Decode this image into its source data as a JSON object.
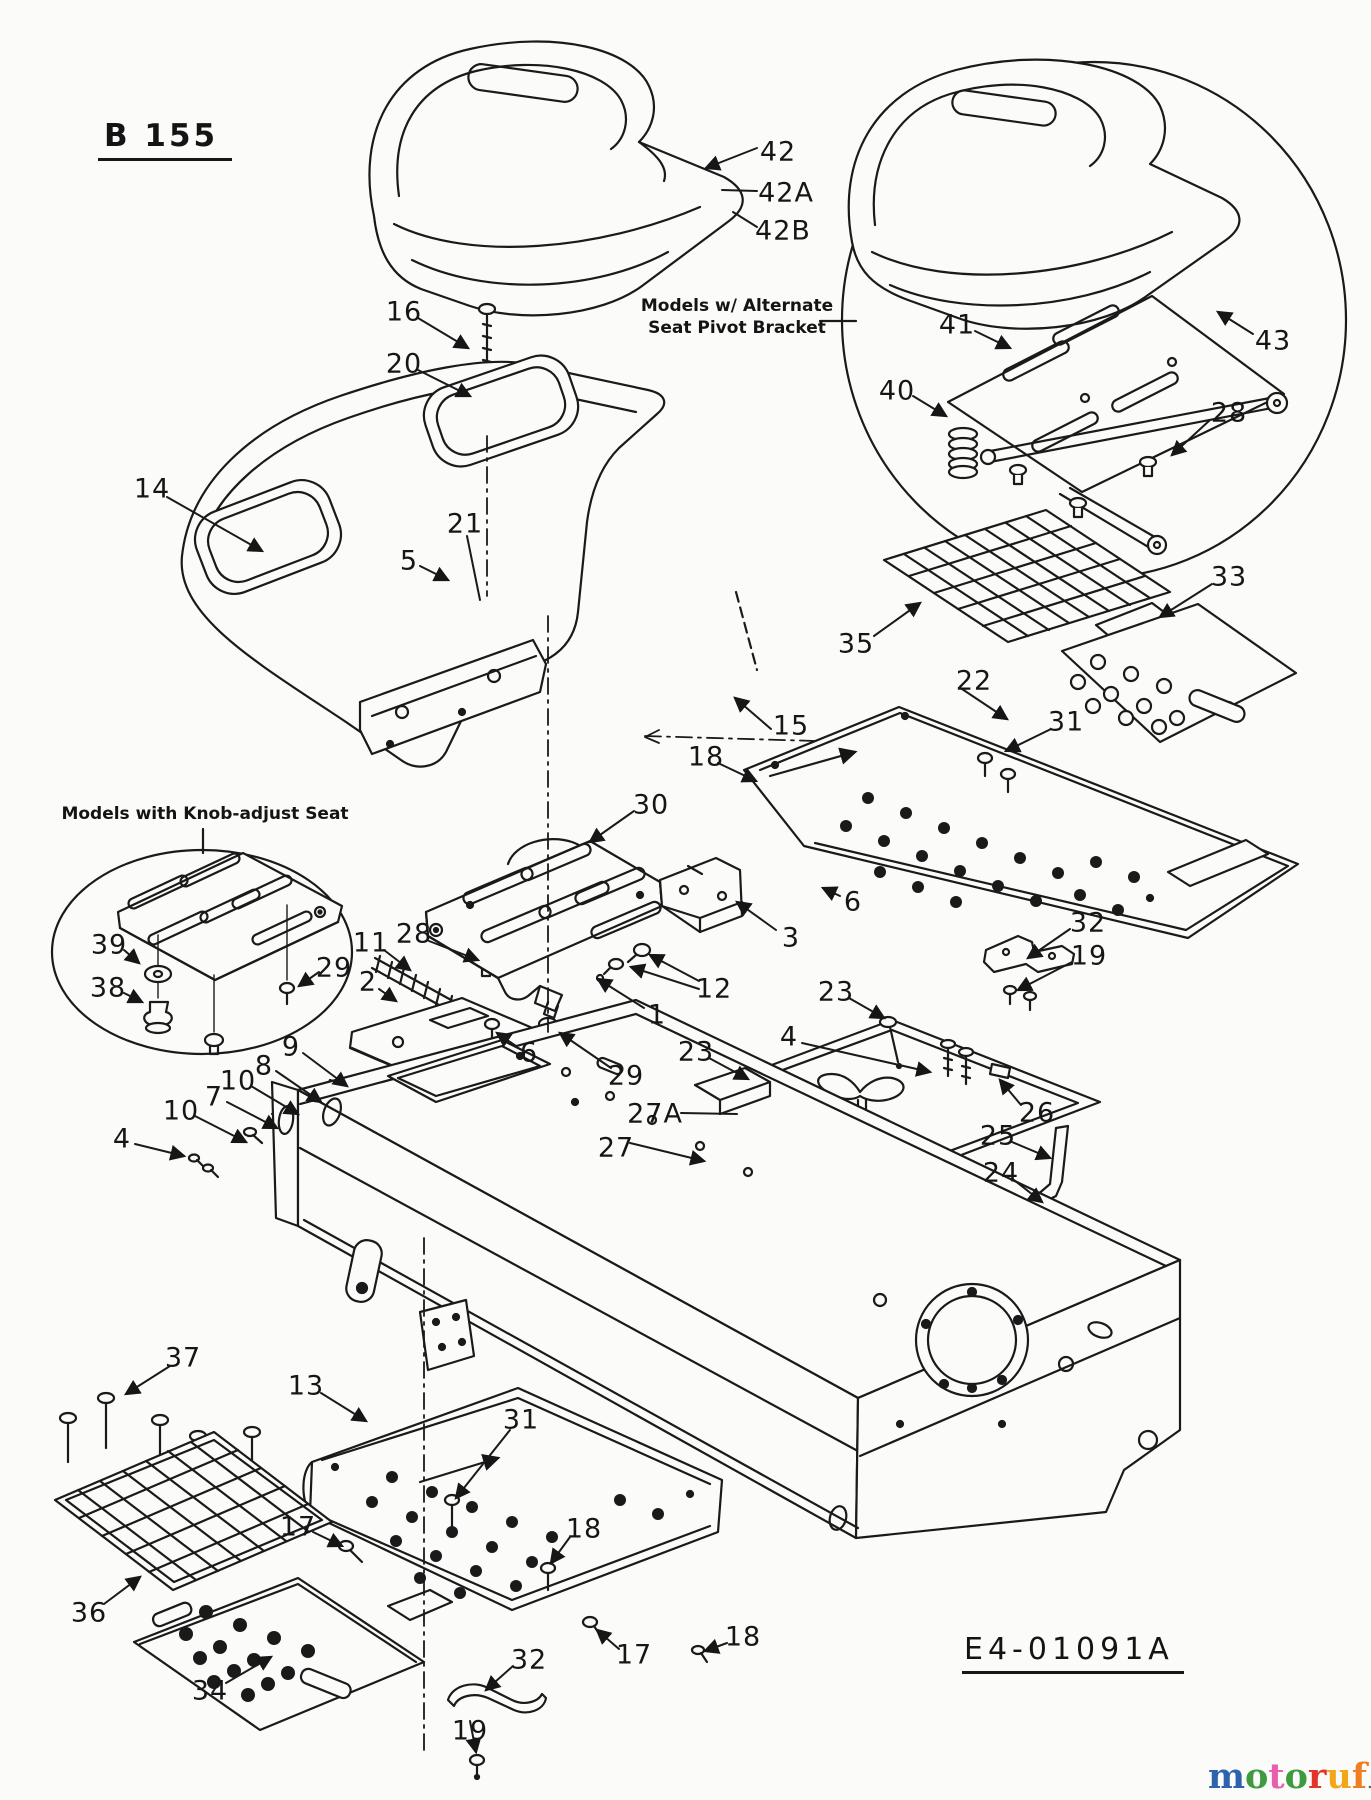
{
  "diagram": {
    "model_code": "B 155",
    "drawing_number": "E4-01091A",
    "notes": {
      "alt_seat": {
        "line1": "Models w/ Alternate",
        "line2": "Seat Pivot Bracket"
      },
      "knob_adjust": "Models with Knob-adjust Seat"
    }
  },
  "watermark": {
    "word": "motoruf",
    "suffix": ".de",
    "letter_colors": [
      "#2d62ae",
      "#3f9b3f",
      "#e85fae",
      "#3f9b3f",
      "#e2342b",
      "#f2a71b",
      "#ef7d21"
    ],
    "suffix_color": "#5a5a5a"
  },
  "callouts": [
    {
      "t": "42",
      "x": 778,
      "y": 152
    },
    {
      "t": "42A",
      "x": 786,
      "y": 193
    },
    {
      "t": "42B",
      "x": 783,
      "y": 231
    },
    {
      "t": "16",
      "x": 404,
      "y": 312
    },
    {
      "t": "20",
      "x": 404,
      "y": 364
    },
    {
      "t": "41",
      "x": 957,
      "y": 325
    },
    {
      "t": "40",
      "x": 897,
      "y": 391
    },
    {
      "t": "43",
      "x": 1273,
      "y": 341
    },
    {
      "t": "28",
      "x": 1229,
      "y": 413
    },
    {
      "t": "14",
      "x": 152,
      "y": 489
    },
    {
      "t": "5",
      "x": 409,
      "y": 561
    },
    {
      "t": "21",
      "x": 465,
      "y": 524
    },
    {
      "t": "35",
      "x": 856,
      "y": 644
    },
    {
      "t": "33",
      "x": 1229,
      "y": 577
    },
    {
      "t": "22",
      "x": 974,
      "y": 681
    },
    {
      "t": "31",
      "x": 1066,
      "y": 722
    },
    {
      "t": "15",
      "x": 791,
      "y": 726
    },
    {
      "t": "18",
      "x": 706,
      "y": 757
    },
    {
      "t": "30",
      "x": 651,
      "y": 805
    },
    {
      "t": "39",
      "x": 109,
      "y": 945
    },
    {
      "t": "38",
      "x": 108,
      "y": 988
    },
    {
      "t": "29",
      "x": 334,
      "y": 968
    },
    {
      "t": "11",
      "x": 371,
      "y": 943
    },
    {
      "t": "28",
      "x": 414,
      "y": 934
    },
    {
      "t": "2",
      "x": 368,
      "y": 982
    },
    {
      "t": "9",
      "x": 291,
      "y": 1047
    },
    {
      "t": "8",
      "x": 264,
      "y": 1066
    },
    {
      "t": "10",
      "x": 238,
      "y": 1081
    },
    {
      "t": "7",
      "x": 214,
      "y": 1097
    },
    {
      "t": "10",
      "x": 181,
      "y": 1111
    },
    {
      "t": "4",
      "x": 122,
      "y": 1139
    },
    {
      "t": "6",
      "x": 529,
      "y": 1053
    },
    {
      "t": "29",
      "x": 626,
      "y": 1076
    },
    {
      "t": "12",
      "x": 714,
      "y": 989
    },
    {
      "t": "1",
      "x": 657,
      "y": 1015
    },
    {
      "t": "3",
      "x": 791,
      "y": 938
    },
    {
      "t": "6",
      "x": 853,
      "y": 902
    },
    {
      "t": "23",
      "x": 696,
      "y": 1052
    },
    {
      "t": "4",
      "x": 789,
      "y": 1037
    },
    {
      "t": "23",
      "x": 836,
      "y": 992
    },
    {
      "t": "27A",
      "x": 655,
      "y": 1114
    },
    {
      "t": "27",
      "x": 616,
      "y": 1148
    },
    {
      "t": "26",
      "x": 1037,
      "y": 1113
    },
    {
      "t": "25",
      "x": 998,
      "y": 1136
    },
    {
      "t": "24",
      "x": 1001,
      "y": 1173
    },
    {
      "t": "32",
      "x": 1088,
      "y": 923
    },
    {
      "t": "19",
      "x": 1089,
      "y": 956
    },
    {
      "t": "37",
      "x": 183,
      "y": 1358
    },
    {
      "t": "13",
      "x": 306,
      "y": 1386
    },
    {
      "t": "31",
      "x": 521,
      "y": 1420
    },
    {
      "t": "17",
      "x": 298,
      "y": 1527
    },
    {
      "t": "18",
      "x": 584,
      "y": 1529
    },
    {
      "t": "36",
      "x": 89,
      "y": 1613
    },
    {
      "t": "34",
      "x": 210,
      "y": 1691
    },
    {
      "t": "32",
      "x": 529,
      "y": 1660
    },
    {
      "t": "19",
      "x": 470,
      "y": 1731
    },
    {
      "t": "17",
      "x": 634,
      "y": 1655
    },
    {
      "t": "18",
      "x": 743,
      "y": 1637
    }
  ]
}
